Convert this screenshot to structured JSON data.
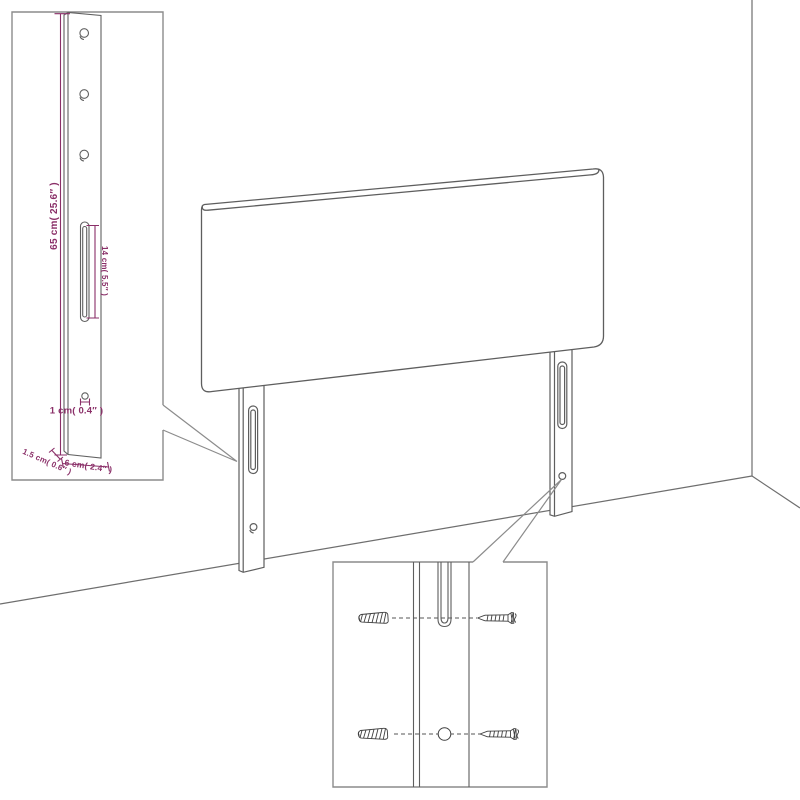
{
  "colors": {
    "background": "#FFFFFF",
    "dimension_accent": "#8A2F68",
    "line_art": "#5E5E5E",
    "callout_border": "#8C8C8C",
    "hardware_detail": "#3F3F3F"
  },
  "dimension_callout": {
    "labels": {
      "leg_height": "65 cm( 25.6″ )",
      "slot_length": "14 cm( 5.5″ )",
      "hole_diameter": "1 cm( 0.4″ )",
      "leg_thickness": "1.5 cm( 0.6″ )",
      "leg_width": "6 cm( 2.4″ )"
    },
    "icons": [
      "leg-strut-icon",
      "screw-hole-icon",
      "mounting-slot-icon"
    ]
  },
  "mounting_callout": {
    "icons": [
      "wall-plug-icon",
      "screw-icon",
      "mounting-slot-icon",
      "mounting-hole-icon"
    ]
  },
  "scene": {
    "icons": [
      "headboard-panel",
      "left-leg",
      "right-leg",
      "wall-corner"
    ]
  }
}
